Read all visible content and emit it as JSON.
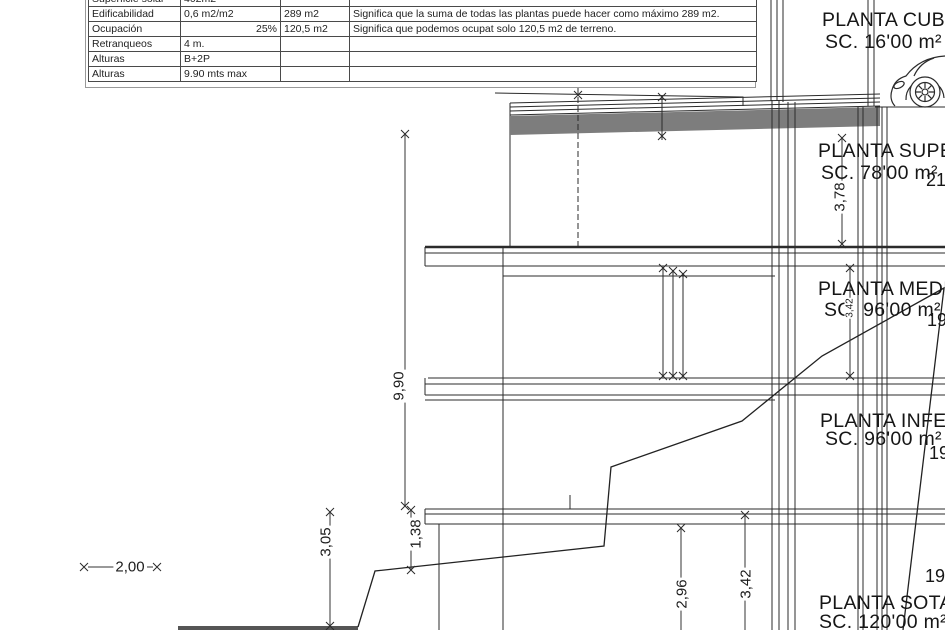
{
  "table": {
    "rows": [
      {
        "c0": "Superficie solar",
        "c1": "402m2",
        "c2": "",
        "c3": ""
      },
      {
        "c0": "Edificabilidad",
        "c1": "0,6 m2/m2",
        "c2": "289 m2",
        "c3": "Significa que la suma de todas las plantas puede hacer como máximo 289 m2."
      },
      {
        "c0": "Ocupación",
        "c1": "25%",
        "c2": "120,5 m2",
        "c3": "Significa que podemos ocupat solo 120,5 m2 de terreno."
      },
      {
        "c0": "Retranqueos",
        "c1": "4 m.",
        "c2": "",
        "c3": ""
      },
      {
        "c0": "Alturas",
        "c1": "B+2P",
        "c2": "",
        "c3": ""
      },
      {
        "c0": "Alturas",
        "c1": "9.90 mts max",
        "c2": "",
        "c3": ""
      }
    ]
  },
  "floors": [
    {
      "name": "PLANTA CUBIERTA",
      "area": "SC. 16'00 m²"
    },
    {
      "name": "PLANTA SUPERIOR",
      "area": "SC. 78'00 m²"
    },
    {
      "name": "PLANTA MEDIA",
      "area": "SC. 96'00 m²"
    },
    {
      "name": "PLANTA INFERIOR",
      "area": "SC. 96'00 m²"
    },
    {
      "name": "PLANTA SOTANO",
      "area": "SC. 120'00 m²"
    }
  ],
  "levels": {
    "l1": "21",
    "l2": "19",
    "l3": "19",
    "l4": "19"
  },
  "dimensions": {
    "total_height": "9,90",
    "roof_floor": "3,78",
    "media_floor": "3,42",
    "left_terrain": "3,05",
    "step": "1,38",
    "basement_a": "2,96",
    "basement_b": "3,42",
    "setback": "2,00"
  },
  "colors": {
    "line": "#2b2b2b",
    "slab_fill": "#7d7d7d",
    "ground": "#555555"
  }
}
